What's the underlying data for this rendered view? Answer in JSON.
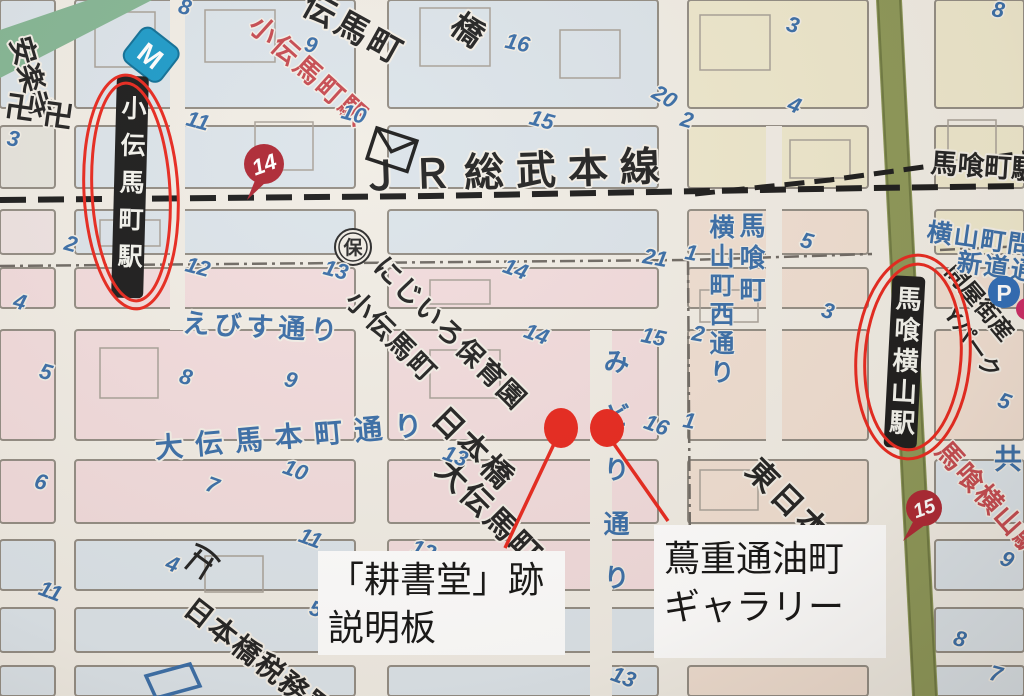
{
  "colors": {
    "annotation_red": "#e8281e",
    "badge_red": "#ad2733",
    "map_blue_text": "#3a6ea8",
    "block_blue": "#dce4ea",
    "block_pink": "#f2dcdd",
    "block_cream": "#eee8cd",
    "block_peach": "#f0dfd2",
    "green_road": "#8d9858",
    "green_band": "#85b694",
    "rail_black": "#1c1c1c",
    "metro_blue": "#1d9bc9",
    "parking_blue": "#2f6db8"
  },
  "railway": {
    "name": "ＪＲ総武本線",
    "bakurocho_station": "馬喰町駅"
  },
  "stations": {
    "kodenmacho": {
      "bar": "小伝馬町駅",
      "red": "小伝馬町駅",
      "badge": "14"
    },
    "bakuroyokoyama": {
      "bar": "馬喰横山駅",
      "red": "馬喰横山駅",
      "badge": "15"
    }
  },
  "streets": {
    "ebisu": "えびす通り",
    "odenma_honcho": "大伝馬本町通り",
    "midori": "みどり通り",
    "yokoyama_nishi": "横山町西通り",
    "yokoyama_shindo_1": "横山町問",
    "yokoyama_shindo_2": "新道通"
  },
  "places": {
    "anrakuji": "安楽寺",
    "manji": "卍",
    "denmacho_diag": "伝馬町",
    "hashi": "橋",
    "hoiku_mark": "保",
    "nijiiro_1": "にじいろ保育園",
    "nijiiro_2": "小伝馬町",
    "odenmacho_1": "日本橋",
    "odenmacho_2": "大伝馬町",
    "bakurocho_v": "馬喰町",
    "higashi": "東日本",
    "toiyagai": "問屋街産",
    "ypark": "Yパーク",
    "kyo": "共",
    "zeimusho": "日本橋税務署",
    "metro": "M",
    "parking": "P"
  },
  "callouts": {
    "spot1_1": "「耕書堂」跡",
    "spot1_2": "説明板",
    "spot2_1": "蔦重通油町",
    "spot2_2": "ギャラリー"
  },
  "lot_numbers": [
    {
      "v": "8",
      "x": 183,
      "y": 14,
      "r": 15
    },
    {
      "v": "11",
      "x": 196,
      "y": 128,
      "r": 15
    },
    {
      "v": "3",
      "x": 12,
      "y": 146,
      "r": 10
    },
    {
      "v": "9",
      "x": 309,
      "y": 52,
      "r": 15
    },
    {
      "v": "10",
      "x": 352,
      "y": 121,
      "r": 15
    },
    {
      "v": "16",
      "x": 516,
      "y": 50,
      "r": 12
    },
    {
      "v": "15",
      "x": 540,
      "y": 127,
      "r": 15
    },
    {
      "v": "20",
      "x": 661,
      "y": 103,
      "r": 30
    },
    {
      "v": "2",
      "x": 685,
      "y": 127,
      "r": 15
    },
    {
      "v": "3",
      "x": 791,
      "y": 32,
      "r": 15
    },
    {
      "v": "4",
      "x": 792,
      "y": 112,
      "r": 20
    },
    {
      "v": "8",
      "x": 997,
      "y": 17,
      "r": 10
    },
    {
      "v": "2",
      "x": 69,
      "y": 251,
      "r": 15
    },
    {
      "v": "4",
      "x": 18,
      "y": 309,
      "r": 15
    },
    {
      "v": "12",
      "x": 196,
      "y": 274,
      "r": 15
    },
    {
      "v": "13",
      "x": 334,
      "y": 277,
      "r": 15
    },
    {
      "v": "14",
      "x": 513,
      "y": 276,
      "r": 20
    },
    {
      "v": "5",
      "x": 44,
      "y": 379,
      "r": 15
    },
    {
      "v": "8",
      "x": 184,
      "y": 384,
      "r": 15
    },
    {
      "v": "9",
      "x": 289,
      "y": 387,
      "r": 15
    },
    {
      "v": "14",
      "x": 534,
      "y": 341,
      "r": 20
    },
    {
      "v": "5",
      "x": 805,
      "y": 248,
      "r": 15
    },
    {
      "v": "1",
      "x": 690,
      "y": 260,
      "r": 10
    },
    {
      "v": "21",
      "x": 654,
      "y": 265,
      "r": 10
    },
    {
      "v": "2",
      "x": 697,
      "y": 341,
      "r": 10
    },
    {
      "v": "15",
      "x": 652,
      "y": 344,
      "r": 12
    },
    {
      "v": "3",
      "x": 826,
      "y": 318,
      "r": 15
    },
    {
      "v": "5",
      "x": 1002,
      "y": 408,
      "r": 20
    },
    {
      "v": "16",
      "x": 654,
      "y": 432,
      "r": 20
    },
    {
      "v": "1",
      "x": 688,
      "y": 428,
      "r": 10
    },
    {
      "v": "13",
      "x": 453,
      "y": 463,
      "r": 20
    },
    {
      "v": "10",
      "x": 293,
      "y": 477,
      "r": 20
    },
    {
      "v": "7",
      "x": 210,
      "y": 492,
      "r": 20
    },
    {
      "v": "12",
      "x": 421,
      "y": 557,
      "r": 20
    },
    {
      "v": "11",
      "x": 308,
      "y": 545,
      "r": 20
    },
    {
      "v": "6",
      "x": 39,
      "y": 489,
      "r": 15
    },
    {
      "v": "4",
      "x": 170,
      "y": 571,
      "r": 20
    },
    {
      "v": "11",
      "x": 48,
      "y": 598,
      "r": 20
    },
    {
      "v": "5",
      "x": 314,
      "y": 616,
      "r": 15
    },
    {
      "v": "9",
      "x": 1004,
      "y": 566,
      "r": 25
    },
    {
      "v": "8",
      "x": 958,
      "y": 646,
      "r": 15
    },
    {
      "v": "7",
      "x": 994,
      "y": 681,
      "r": 15
    },
    {
      "v": "13",
      "x": 621,
      "y": 684,
      "r": 20
    }
  ]
}
